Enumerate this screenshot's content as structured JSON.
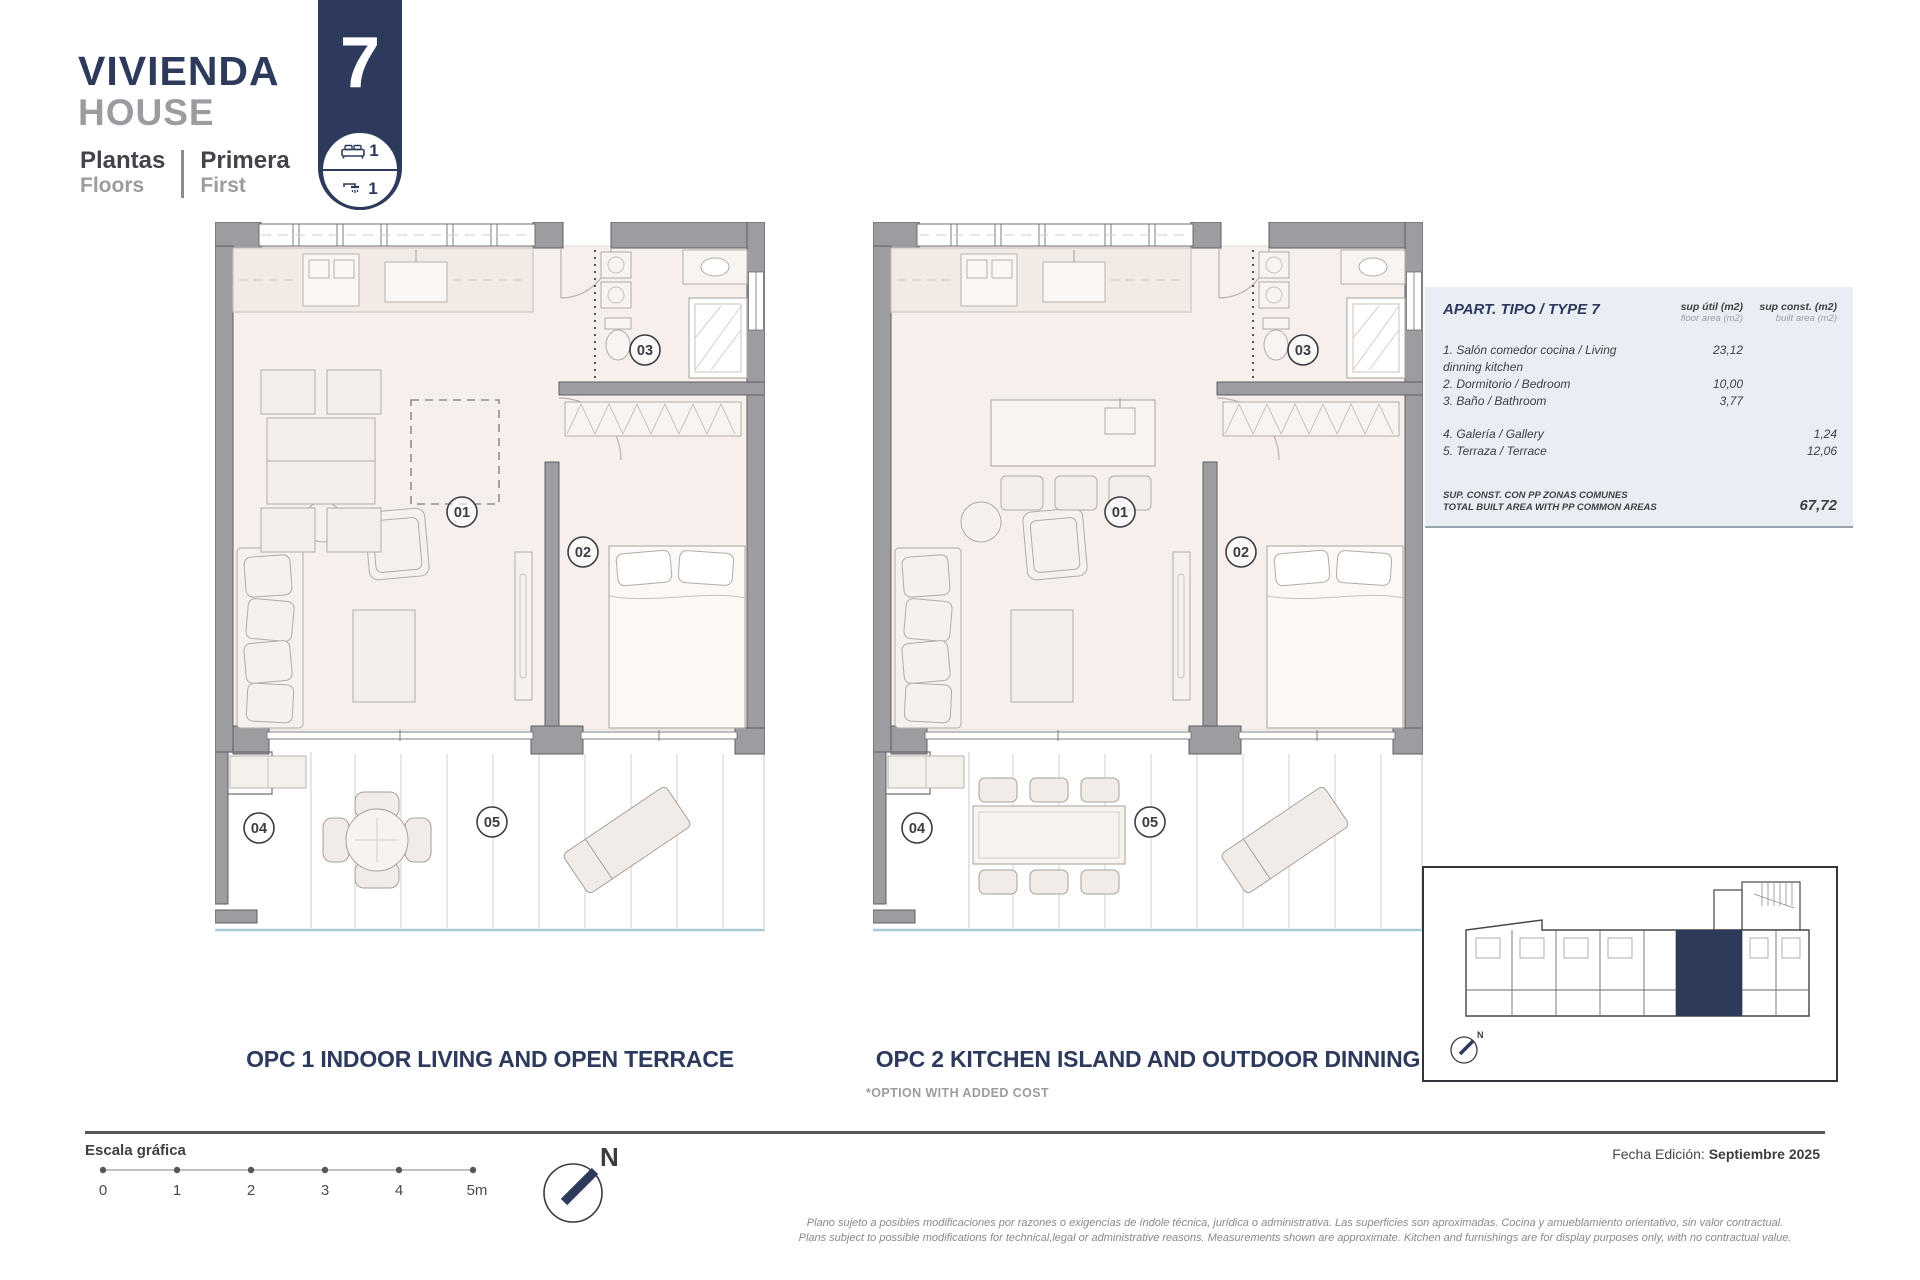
{
  "header": {
    "title_es": "VIVIENDA",
    "title_en": "HOUSE",
    "floors_label_es": "Plantas",
    "floors_label_en": "Floors",
    "floor_value_es": "Primera",
    "floor_value_en": "First"
  },
  "unit": {
    "number": "7",
    "bedrooms": "1",
    "bathrooms": "1"
  },
  "area_table": {
    "title": "APART. TIPO / TYPE 7",
    "col_util_es": "sup útil (m2)",
    "col_util_en": "floor area (m2)",
    "col_const_es": "sup const. (m2)",
    "col_const_en": "built area (m2)",
    "rows": [
      {
        "label": "1. Salón comedor cocina / Living dinning kitchen",
        "util": "23,12",
        "const": ""
      },
      {
        "label": "2. Dormitorio / Bedroom",
        "util": "10,00",
        "const": ""
      },
      {
        "label": "3. Baño / Bathroom",
        "util": "3,77",
        "const": ""
      },
      {
        "label": "4. Galería / Gallery",
        "util": "",
        "const": "1,24"
      },
      {
        "label": "5. Terraza / Terrace",
        "util": "",
        "const": "12,06"
      }
    ],
    "total_label_es": "SUP. CONST. CON PP ZONAS COMUNES",
    "total_label_en": "TOTAL BUILT AREA WITH PP COMMON AREAS",
    "total_value": "67,72"
  },
  "room_labels": [
    "01",
    "02",
    "03",
    "04",
    "05"
  ],
  "plans": [
    {
      "title": "OPC 1 INDOOR LIVING AND OPEN TERRACE",
      "note": ""
    },
    {
      "title": "OPC 2 KITCHEN ISLAND AND OUTDOOR DINNING",
      "note": "*OPTION WITH ADDED COST"
    }
  ],
  "scale": {
    "label": "Escala gráfica",
    "ticks": [
      "0",
      "1",
      "2",
      "3",
      "4",
      "5m"
    ]
  },
  "compass": {
    "label": "N"
  },
  "footer": {
    "date_label": "Fecha Edición:",
    "date_value": "Septiembre 2025",
    "legal_line1": "Plano sujeto a posibles modificaciones por razones o exigencias de índole técnica,  jurídica o administrativa. Las superficies son aproximadas. Cocina y amueblamiento orientativo, sin valor contractual.",
    "legal_line2": "Plans subject to possible modifications for technical,legal or administrative reasons. Measurements shown are approximate. Kitchen and furnishings are for display purposes only, with no contractual value."
  },
  "colors": {
    "accent_navy": "#2d3a5c",
    "wall_gray": "#9d9da1",
    "floor_beige": "#f6efeb",
    "table_bg": "#e9edf4",
    "terrace_edge_blue": "#a9c9d6"
  }
}
